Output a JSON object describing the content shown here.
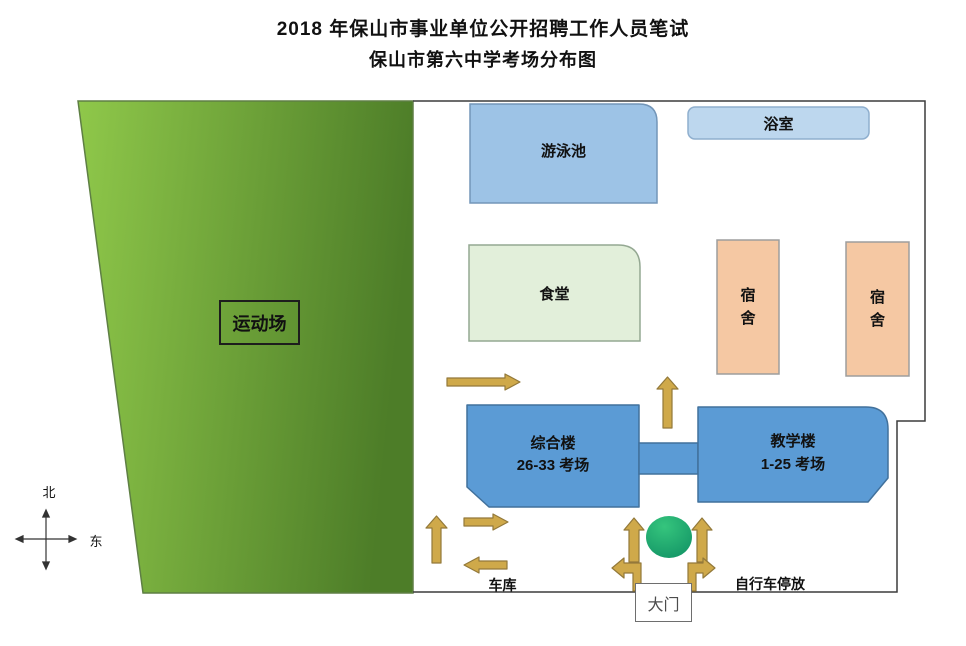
{
  "title": {
    "line1": "2018 年保山市事业单位公开招聘工作人员笔试",
    "line2": "保山市第六中学考场分布图"
  },
  "compass": {
    "north": "北",
    "east": "东"
  },
  "areas": {
    "sports_field": {
      "label": "运动场"
    },
    "swimming_pool": {
      "label": "游泳池"
    },
    "bath_house": {
      "label": "浴室"
    },
    "cafeteria": {
      "label": "食堂"
    },
    "dormitory_1": {
      "label": "宿舍"
    },
    "dormitory_2": {
      "label": "宿舍"
    },
    "complex_building": {
      "name": "综合楼",
      "rooms": "26-33 考场"
    },
    "teaching_building": {
      "name": "教学楼",
      "rooms": "1-25 考场"
    },
    "garage": {
      "label": "车库"
    },
    "bike_parking": {
      "label": "自行车停放"
    },
    "main_gate": {
      "label": "大门"
    }
  },
  "colors": {
    "field_light": "#8fc84a",
    "field_dark": "#4d7d28",
    "field_stroke": "#5e7f44",
    "boundary": "#3c3c3c",
    "pool_fill": "#9dc3e6",
    "pool_stroke": "#7396b8",
    "bath_fill": "#bdd7ee",
    "bath_stroke": "#8fafce",
    "cafeteria_fill": "#e2efda",
    "cafeteria_stroke": "#94a892",
    "dorm_fill": "#f5c8a3",
    "dorm_stroke": "#9d9d9d",
    "building_fill": "#5b9bd5",
    "building_stroke": "#41719c",
    "arrow_fill": "#cfa94a",
    "arrow_stroke": "#93793a",
    "circle_light": "#35c57d",
    "circle_dark": "#0f8f63",
    "compass_stroke": "#333333"
  }
}
